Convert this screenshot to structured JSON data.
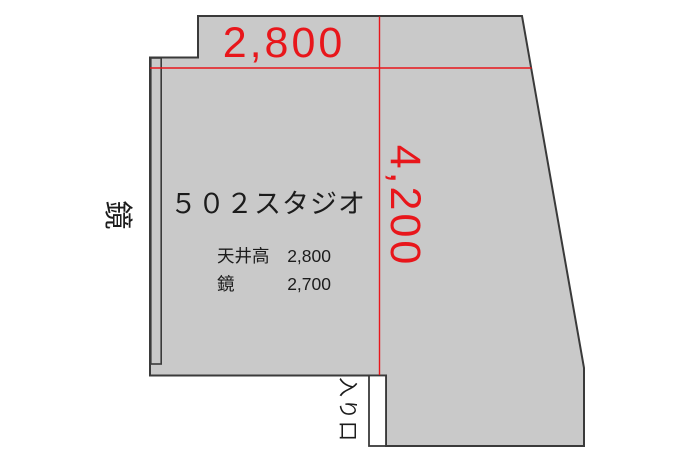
{
  "room": {
    "title": "５０２スタジオ"
  },
  "dimensions": {
    "width": "2,800",
    "depth": "4,200"
  },
  "specs": [
    {
      "label": "天井高",
      "value": "2,800"
    },
    {
      "label": "鏡",
      "value": "2,700"
    }
  ],
  "labels": {
    "mirror": "鏡",
    "entrance": "入り口"
  },
  "colors": {
    "room_fill": "#c9c9c9",
    "wall_line": "#3a3a3a",
    "dimension_red": "#e8161b",
    "text_black": "#1c1c1c",
    "background": "#ffffff"
  }
}
